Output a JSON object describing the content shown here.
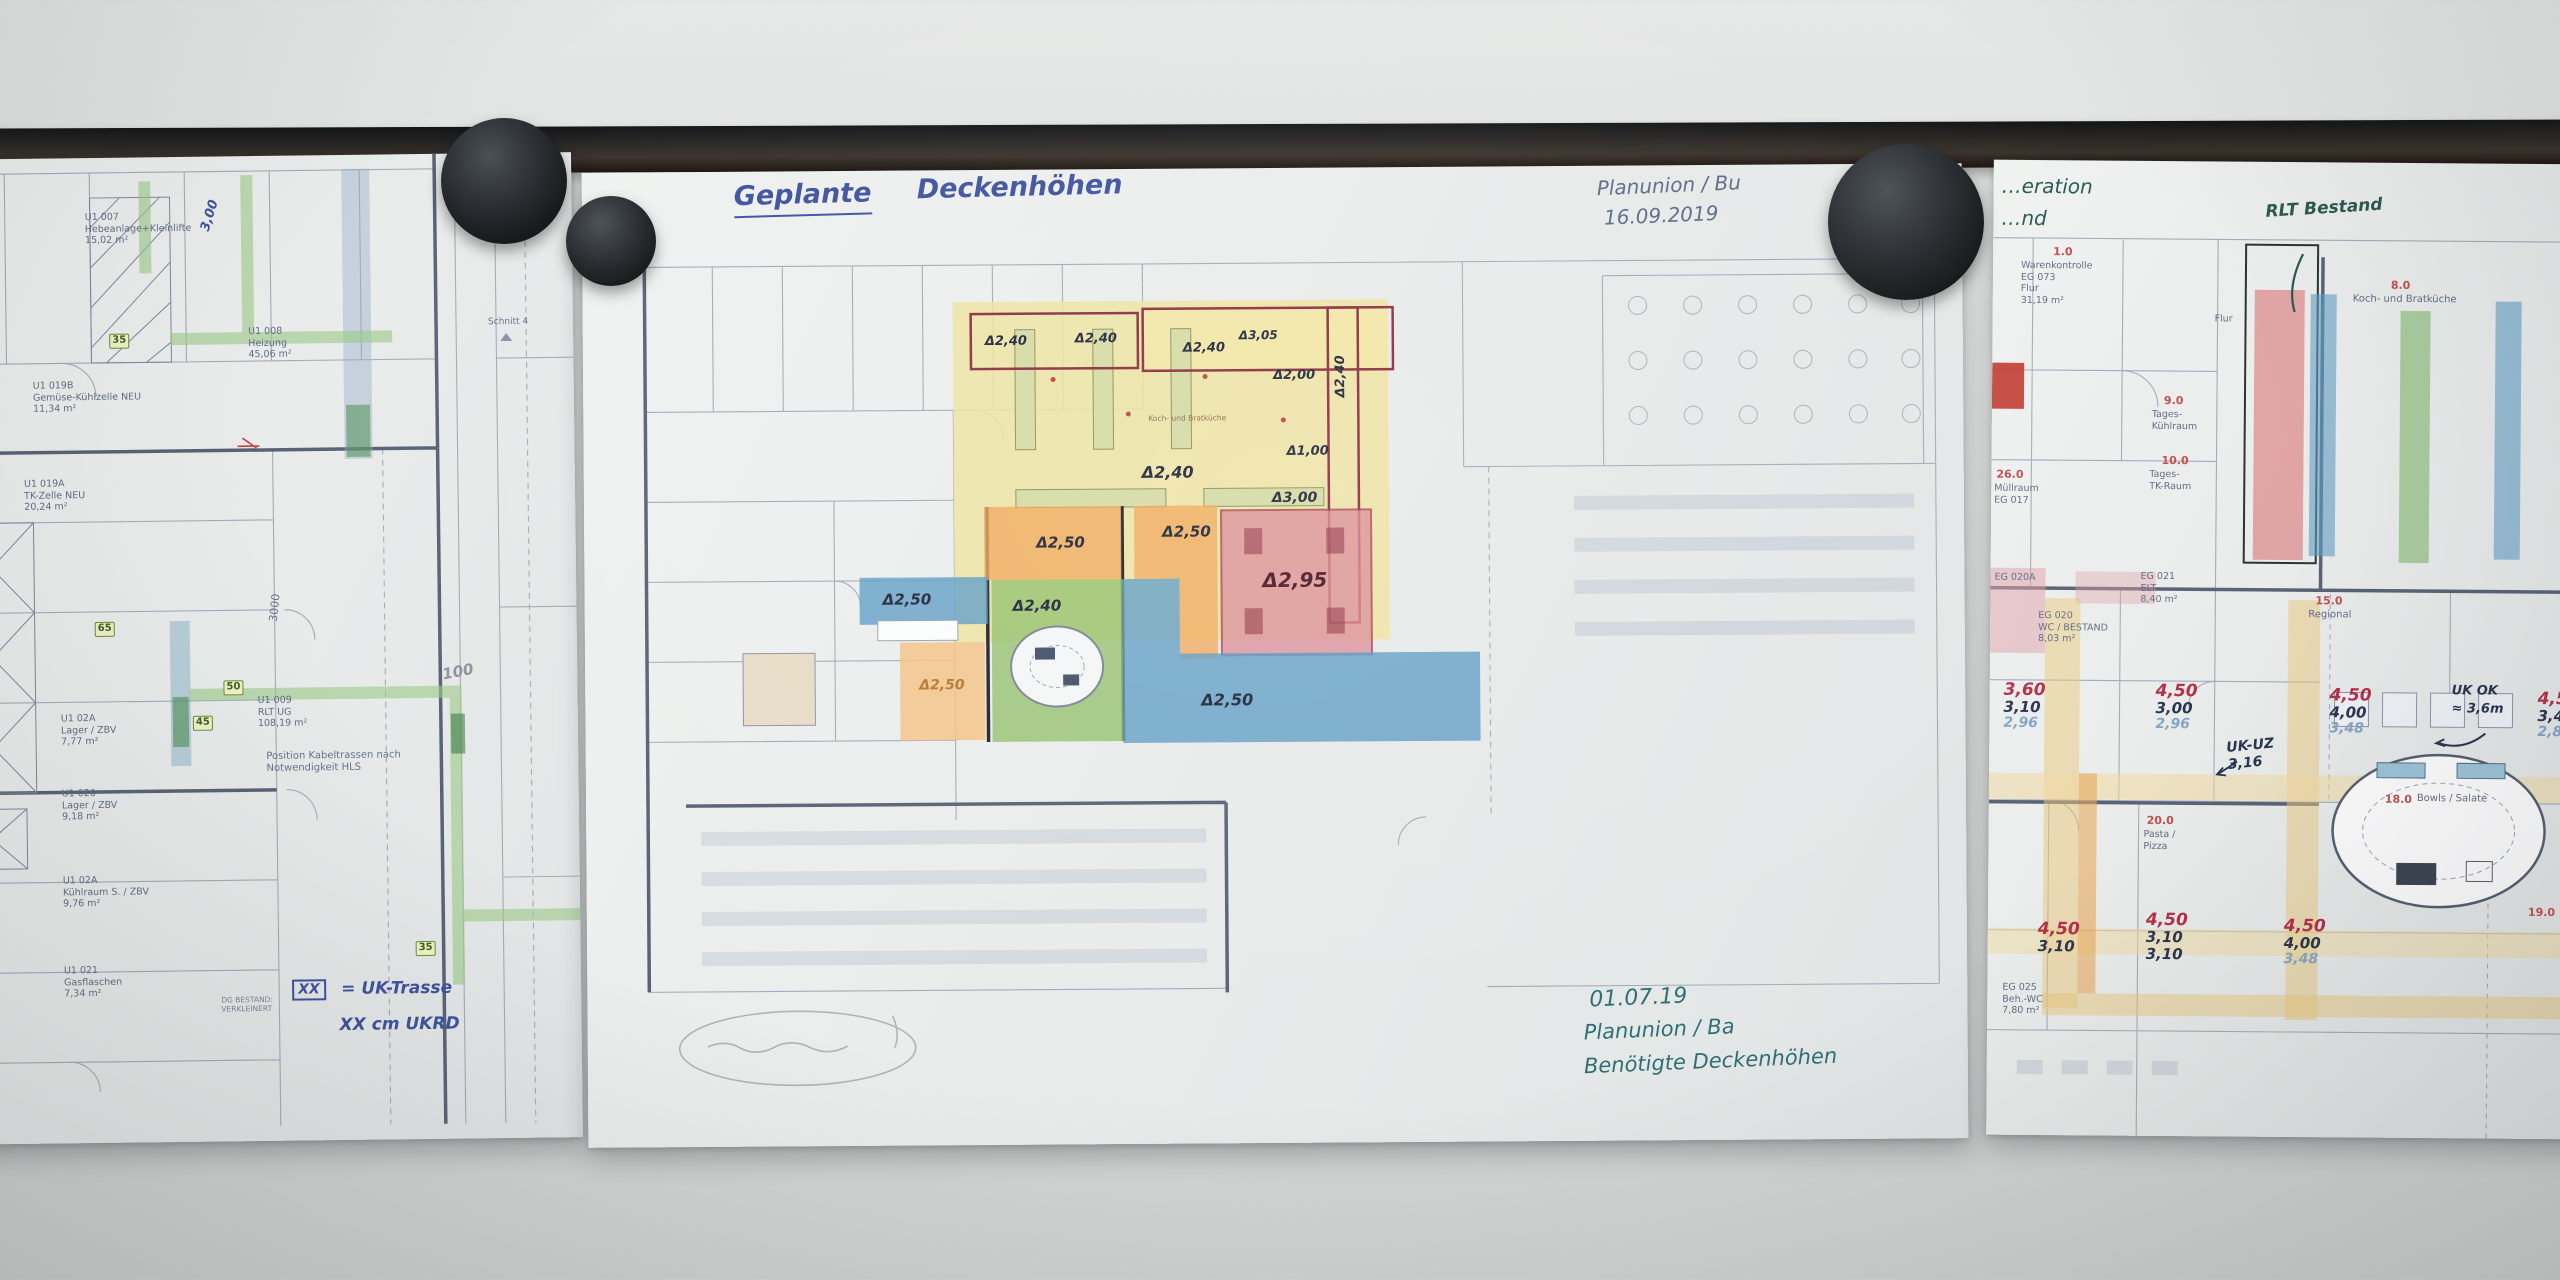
{
  "scene": {
    "description": "Three architectural floor plan printouts hanging from a dark picture rail on a white wall, held by round black magnets, annotated by hand with ceiling heights"
  },
  "colors": {
    "wall": "#d9dbda",
    "rail": "#2d2a26",
    "paper": "#eceeee",
    "ink_blue": "#3f539e",
    "ink_teal": "#2e6f73",
    "ink_green": "#2b5a50",
    "red_marker": "#b5304a",
    "navy_marker": "#2a3550",
    "lightblue_marker": "#85a6c5",
    "zone_yellow": "#efe3a0",
    "zone_orange": "#f0a85a",
    "zone_green": "#8fbf68",
    "zone_blue": "#5f9dc4",
    "zone_pink": "#dc8b97",
    "highlight_green": "#9cc98b"
  },
  "left": {
    "rooms": [
      "U1 007\nHebeanlage+Kleinlifte\n15,02 m²",
      "U1 008\nHeizung\n45,06 m²",
      "U1 019B\nGemüse-Kühlzelle NEU\n11,34 m²",
      "U1 019A\nTK-Zelle NEU\n20,24 m²",
      "U1 009\nRLT UG\n108,19 m²",
      "U1 02A\nLager / ZBV\n7,77 m²",
      "U1 020\nLager / ZBV\n9,18 m²",
      "U1 02A\nKühlraum S. / ZBV\n9,76 m²",
      "U1 021\nGasflaschen\n7,34 m²"
    ],
    "sections": [
      "Schnitt 3",
      "Schnitt 4"
    ],
    "note": "Position Kabeltrassen nach\nNotwendigkeit HLS",
    "stamp": "DG BESTAND:\nVERKLEINERT",
    "dims": {
      "d3000": "3000",
      "d100": "100",
      "d300": "3,00"
    },
    "tags": [
      "35",
      "65",
      "50",
      "45",
      "35"
    ],
    "legend": {
      "box": "XX",
      "line1": "= UK-Trasse",
      "line2": "XX cm UKRD"
    }
  },
  "middle": {
    "title_word1": "Geplante",
    "title_word2": "Deckenhöhen",
    "planner_note": {
      "line1": "Planunion / Bu",
      "line2": "16.09.2019"
    },
    "required_note": {
      "line1": "01.07.19",
      "line2": "Planunion / Ba",
      "line3": "Benötigte Deckenhöhen"
    },
    "kitchen_label": "Koch- und Bratküche",
    "ceiling_heights": {
      "corridor_a": "Δ2,40",
      "corridor_b": "Δ2,40",
      "kitchen_top": "Δ2,40",
      "kitchen_305": "Δ3,05",
      "kitchen_200": "Δ2,00",
      "kitchen_right": "Δ2,40",
      "kitchen_mid": "Δ2,40",
      "kitchen_300": "Δ3,00",
      "kitchen_100": "Δ1,00",
      "orange_a": "Δ2,50",
      "orange_b": "Δ2,50",
      "orange_c": "Δ2,50",
      "blue_left": "Δ2,50",
      "green": "Δ2,40",
      "blue_right": "Δ2,50",
      "pink": "Δ2,95"
    }
  },
  "right": {
    "hand_partial": {
      "line1": "…eration",
      "line2": "…nd"
    },
    "rlt_note": "RLT Bestand",
    "uk_ok": {
      "line1": "UK OK",
      "line2": "≈ 3,6m"
    },
    "uk_uz": "UK-UZ\n3,16",
    "areas": [
      {
        "no": "1.0",
        "name": "Warenkontrolle\nEG 073\nFlur\n31,19 m²"
      },
      {
        "no": "26.0",
        "name": "Müllraum\nEG 017"
      },
      {
        "no": "9.0",
        "name": "Tages-\nKühlraum"
      },
      {
        "no": "10.0",
        "name": "Tages-\nTK-Raum"
      },
      {
        "no": "",
        "name": "Flur"
      },
      {
        "no": "8.0",
        "name": "Koch- und Bratküche"
      },
      {
        "no": "15.0",
        "name": "Regional"
      },
      {
        "no": "18.0",
        "name": "Bowls / Salate"
      },
      {
        "no": "20.0",
        "name": "Pasta /\nPizza"
      },
      {
        "no": "19.0",
        "name": ""
      },
      {
        "no": "",
        "name": "EG 021\nELT\n8,40 m²"
      },
      {
        "no": "",
        "name": "EG 020\nWC / BESTAND\n8,03 m²"
      },
      {
        "no": "",
        "name": "EG 020A"
      },
      {
        "no": "",
        "name": "EG 025\nBeh.-WC\n7,80 m²"
      }
    ],
    "height_stacks": [
      [
        "3,60",
        "3,10",
        "2,96"
      ],
      [
        "4,50",
        "3,00",
        "2,96"
      ],
      [
        "4,50",
        "4,00",
        "3,48"
      ],
      [
        "4,50",
        "3,40",
        "2,85"
      ],
      [
        "4,50",
        "3,10"
      ],
      [
        "4,50",
        "3,10",
        "3,10"
      ],
      [
        "4,50",
        "4,00",
        "3,48"
      ]
    ]
  }
}
